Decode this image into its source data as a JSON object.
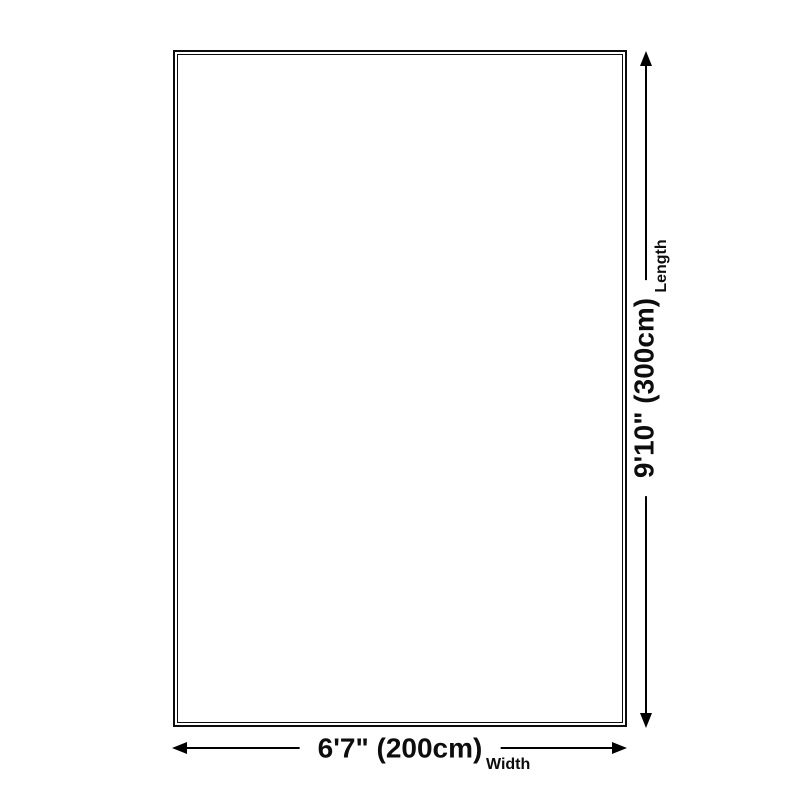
{
  "rug_diagram": {
    "background_color": "#ffffff",
    "line_color": "#000000",
    "outline_color": "#0d0d0d",
    "width": {
      "value": "6'7\" (200cm)",
      "label": "Width"
    },
    "length": {
      "value": "9'10\" (300cm)",
      "label": "Length"
    }
  }
}
